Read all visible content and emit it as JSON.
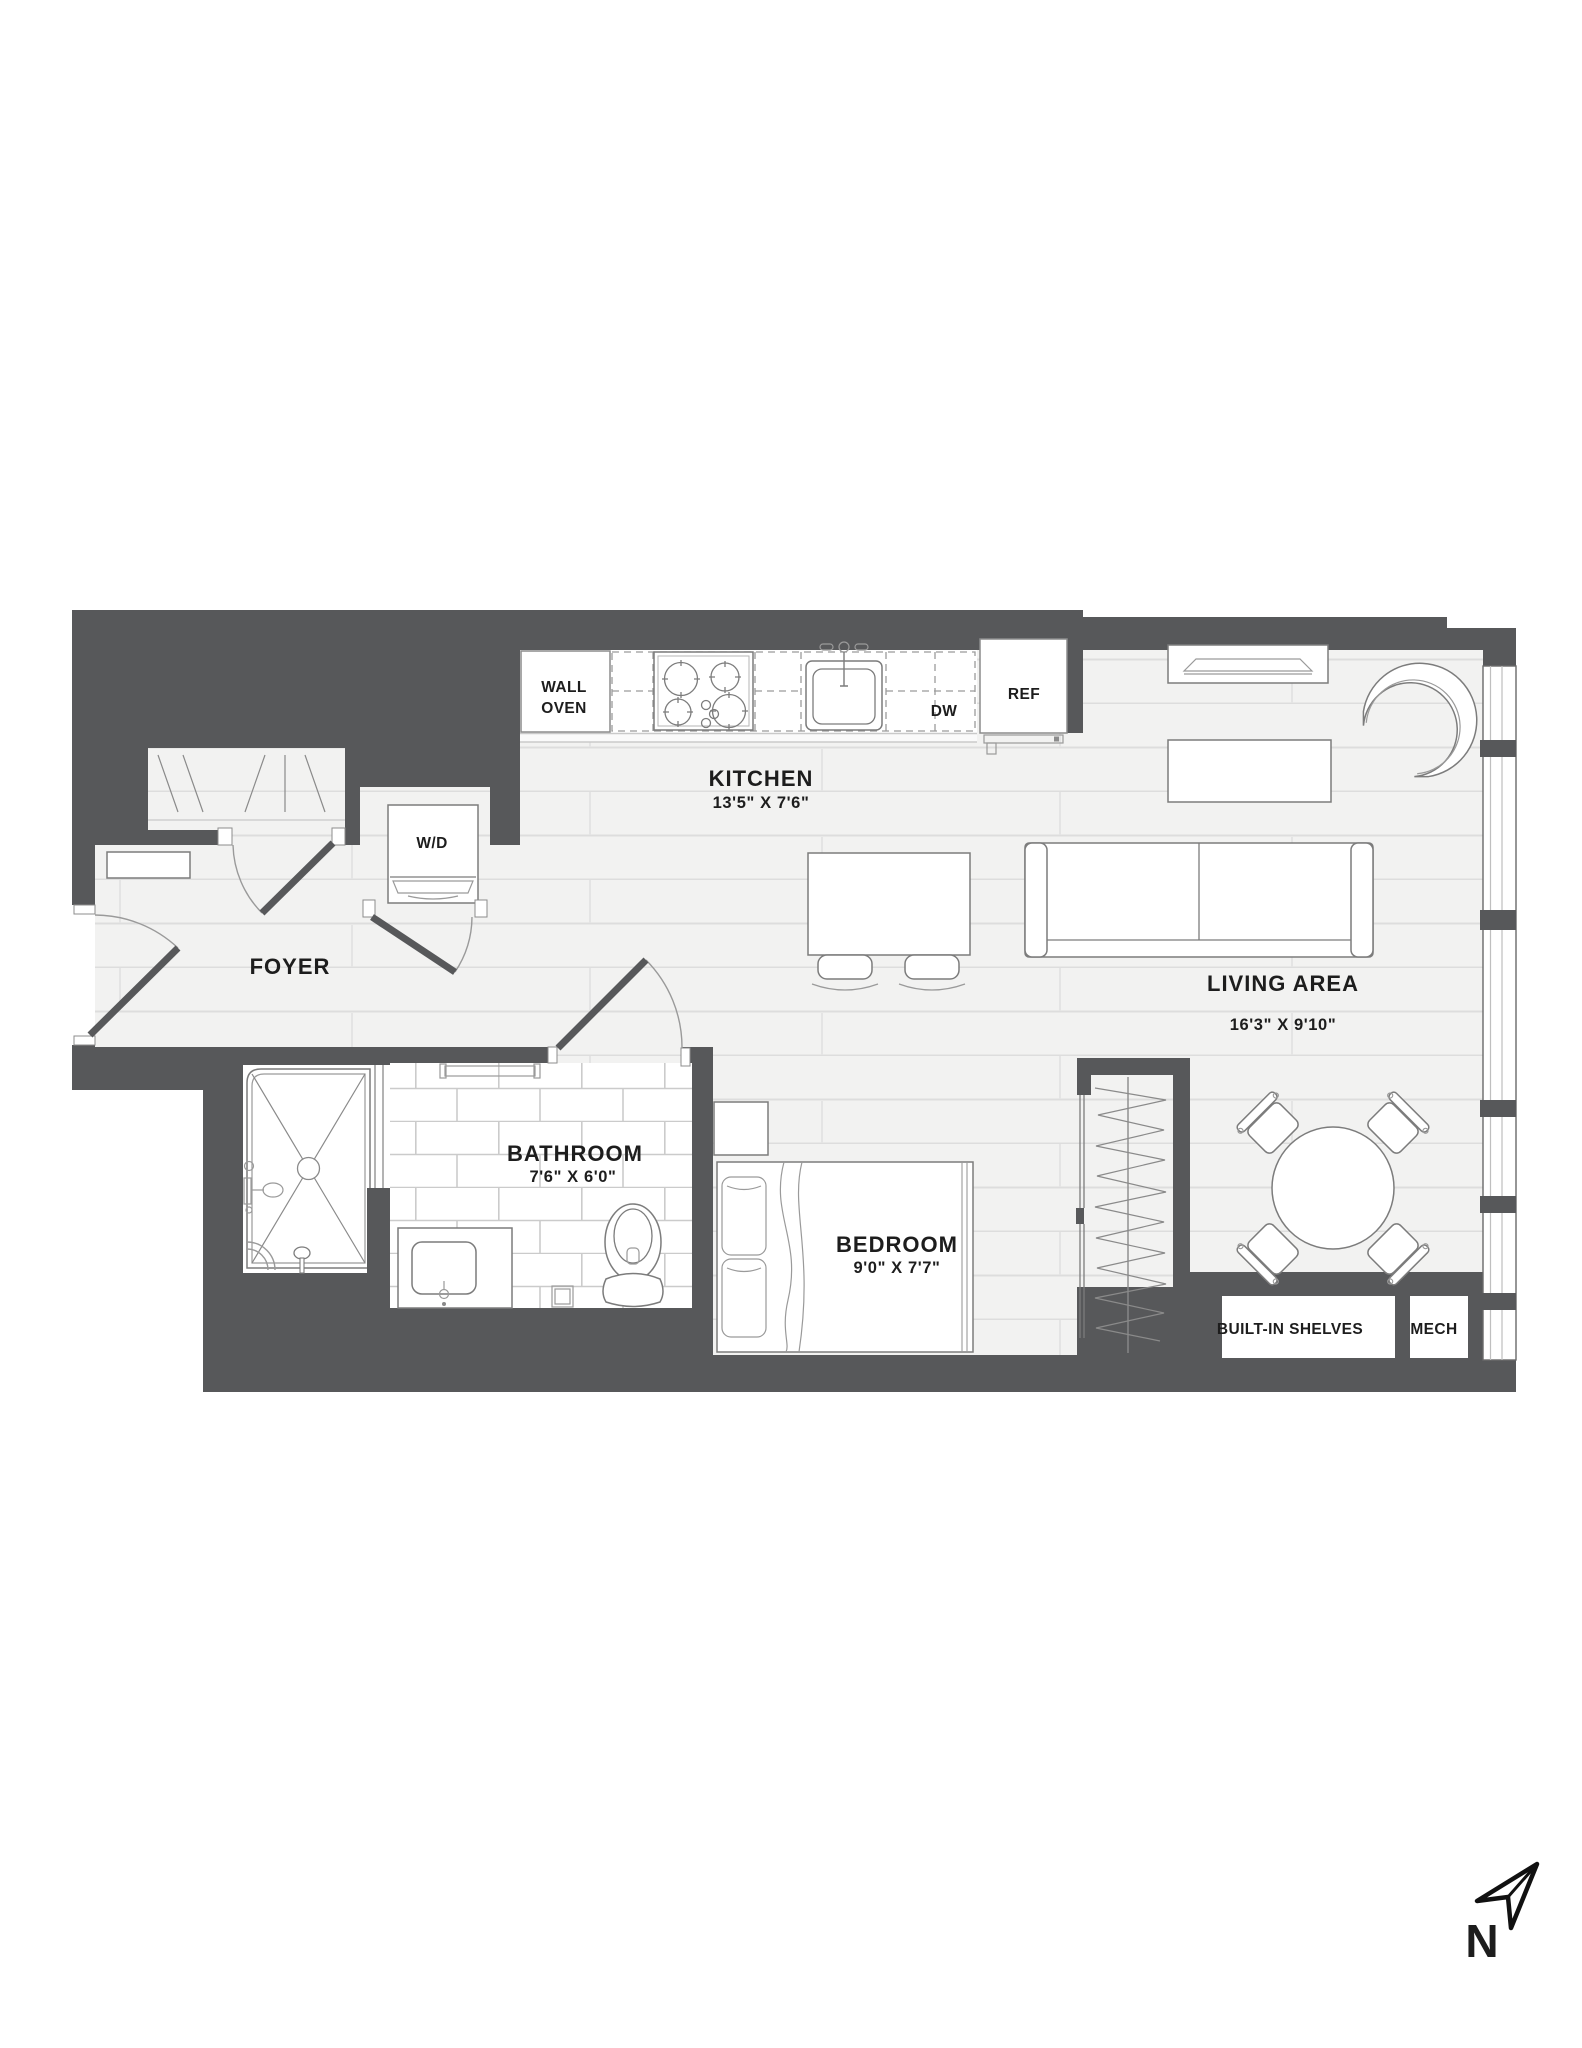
{
  "plan": {
    "type": "apartment-floor-plan",
    "colors": {
      "wall": "#57585a",
      "floor": "#f2f2f1",
      "floor_line": "#dddddd",
      "tile_line": "#cbcbcb",
      "fixture_stroke": "#7c7c7c",
      "text": "#1d1d1d",
      "compass": "#111111"
    },
    "rooms": {
      "foyer": {
        "label": "FOYER"
      },
      "kitchen": {
        "label": "KITCHEN",
        "dims": "13'5\" X 7'6\""
      },
      "living_area": {
        "label": "LIVING AREA",
        "dims": "16'3\" X 9'10\""
      },
      "bathroom": {
        "label": "BATHROOM",
        "dims": "7'6\" X 6'0\""
      },
      "bedroom": {
        "label": "BEDROOM",
        "dims": "9'0\" X 7'7\""
      }
    },
    "features": {
      "wall_oven_line1": "WALL",
      "wall_oven_line2": "OVEN",
      "dishwasher": "DW",
      "refrigerator": "REF",
      "washer_dryer": "W/D",
      "built_in_shelves": "BUILT-IN SHELVES",
      "mechanical": "MECH"
    },
    "compass": {
      "north_label": "N"
    }
  }
}
